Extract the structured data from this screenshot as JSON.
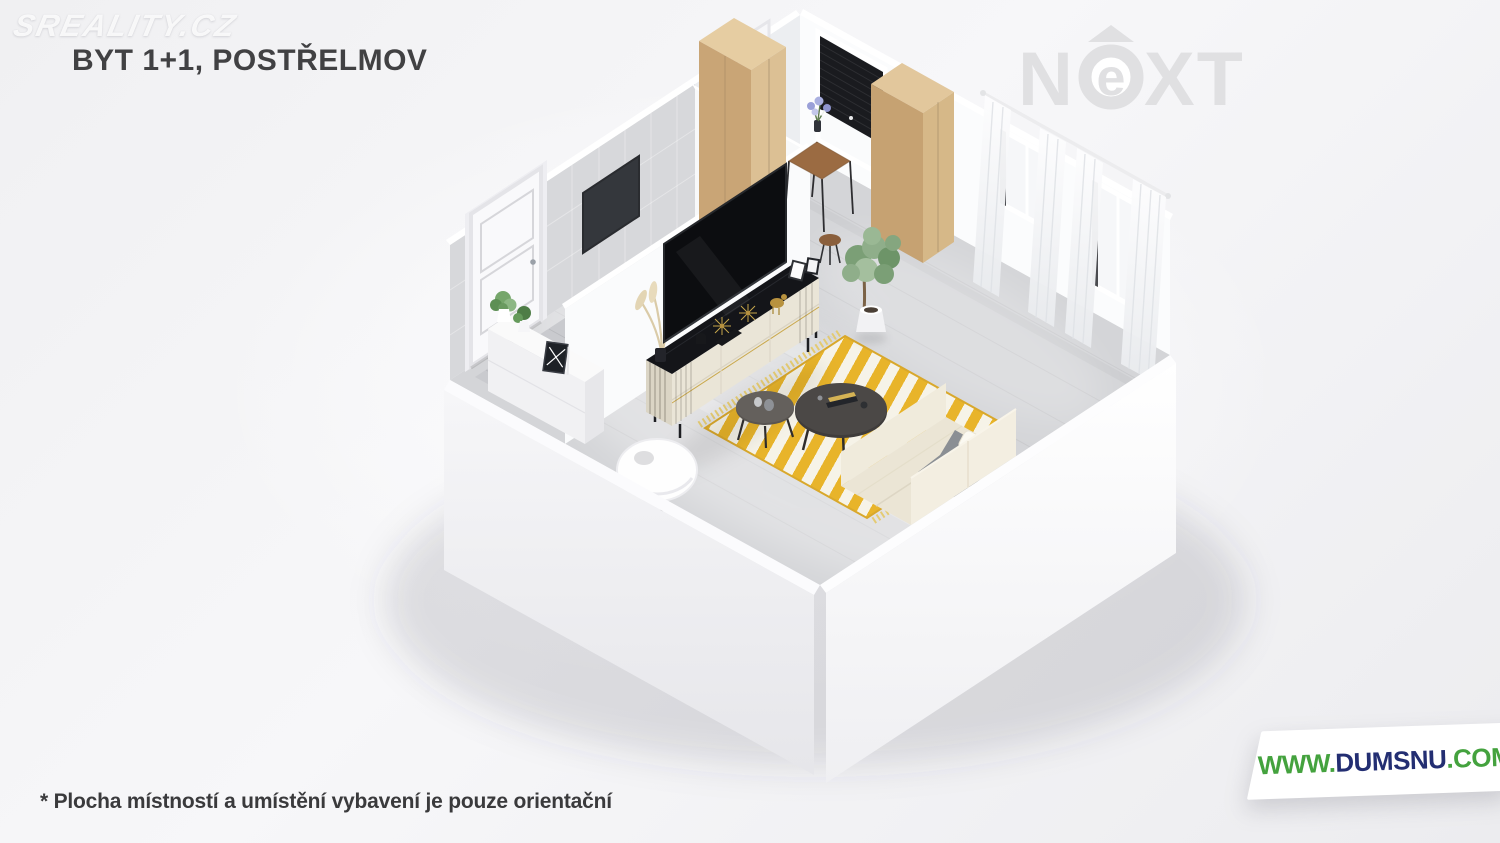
{
  "header": {
    "watermark": "SREALITY.CZ",
    "title": "BYT 1+1, POSTŘELMOV"
  },
  "brand_next": {
    "letter_n": "N",
    "letter_e": "e",
    "letters_xt": "XT"
  },
  "badge_dumsnu": {
    "prefix": "WWW.",
    "name": "DUMSNU",
    "suffix": ".COM"
  },
  "footer": {
    "disclaimer": "* Plocha místností a umístění vybavení je pouze orientační"
  },
  "palette": {
    "background": "#f2f2f4",
    "title_text": "#414143",
    "next_logo_gray": "#e0e0e2",
    "dumsnu_green": "#44a23e",
    "dumsnu_navy": "#232e72",
    "floor_wood_gray": "#d4d5d8",
    "bathroom_tile_gray": "#c9cace",
    "rug_yellow": "#e8b42a",
    "rug_white": "#f6f3e8",
    "wardrobe_wood": "#d3b385",
    "wall_white": "#fafbfc",
    "tv_black": "#0c0d10",
    "sofa_cream": "#ebe5d5",
    "blanket_gray": "#8b8f94"
  }
}
